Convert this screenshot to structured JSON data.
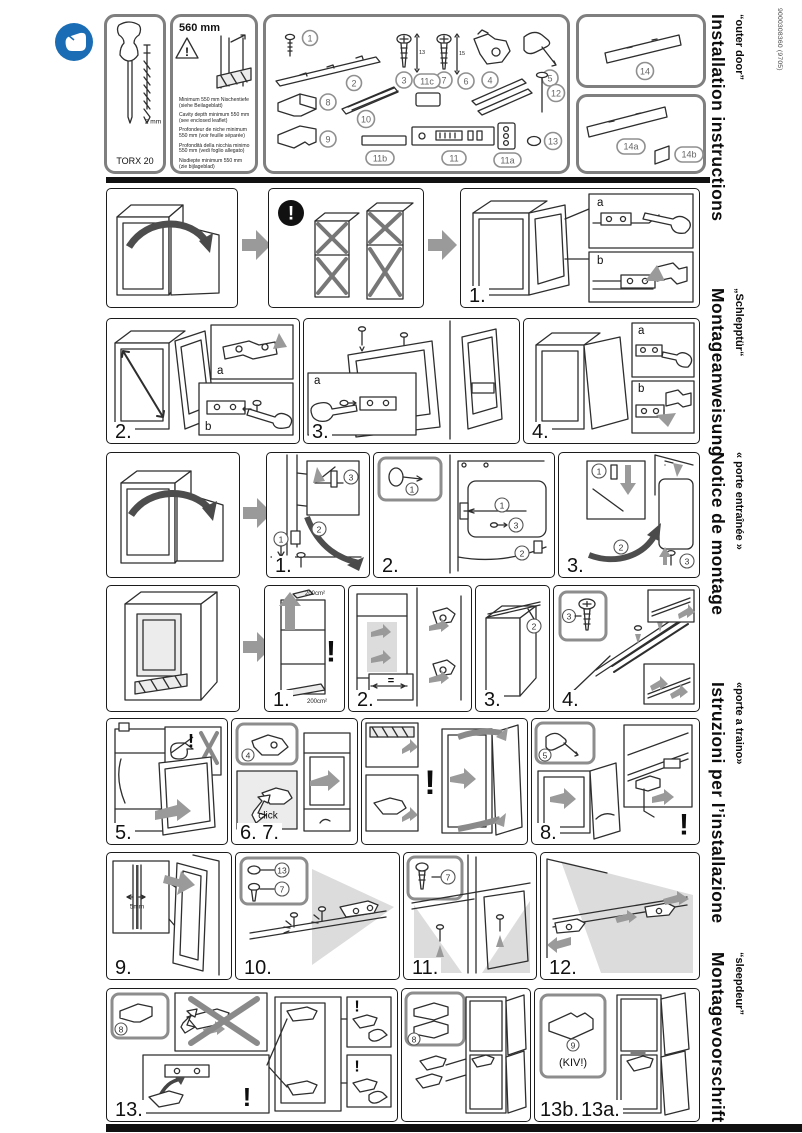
{
  "doc_code": "9000308360 (9705)",
  "sidebar": {
    "languages": [
      {
        "title": "Installation instructions",
        "subtitle": "“outer door”"
      },
      {
        "title": "Montageanweisung",
        "subtitle": "„Schlepptür“"
      },
      {
        "title": "Notice de montage",
        "subtitle": "« porte entraînée »"
      },
      {
        "title": "Istruzioni per l’installazione",
        "subtitle": "«porte a traino»"
      },
      {
        "title": "Montagevoorschrift",
        "subtitle": "“sleepdeur”"
      }
    ]
  },
  "tools": {
    "torx": "TORX 20",
    "bit_size": "2 mm"
  },
  "niche": {
    "depth": "560 mm",
    "warning_mark": "!",
    "notes": [
      "Minimum 550 mm Nischentiefe (siehe Beilageblatt)",
      "Cavity depth minimum 550 mm (see enclosed leaflet)",
      "Profondeur de niche minimum 550 mm (voir feuille séparée)",
      "Profondità della nicchia minimo 550 mm (vedi foglio allegato)",
      "Nisdiepte minimum 550 mm (zie bijlageblad)"
    ]
  },
  "parts": {
    "p1": "1",
    "p2": "2",
    "p3": "3",
    "p4": "4",
    "p5": "5",
    "p6": "6",
    "p7": "7",
    "p8": "8",
    "p9": "9",
    "p10": "10",
    "p11": "11",
    "p11a": "11a",
    "p11b": "11b",
    "p11c": "11c",
    "p12": "12",
    "p13": "13",
    "p14": "14",
    "p14a": "14a",
    "p14b": "14b",
    "dim3": "13",
    "dim7": "15"
  },
  "steps": {
    "s1": "1.",
    "s2": "2.",
    "s3": "3.",
    "s4": "4.",
    "s5": "5.",
    "s67": "6. 7.",
    "s8": "8.",
    "s9": "9.",
    "s10": "10.",
    "s11": "11.",
    "s12": "12.",
    "s13": "13.",
    "s13b": "13b.",
    "s13a": "13a."
  },
  "insets": {
    "a": "a",
    "b": "b"
  },
  "callouts": {
    "c1": "1",
    "c2": "2",
    "c3": "3",
    "c4": "4",
    "c5": "5",
    "c7": "7",
    "c8": "8",
    "c9": "9",
    "c12": "12",
    "c13": "13"
  },
  "annotations": {
    "exclamation": "!",
    "click": "click",
    "kiv": "(KIV!)",
    "gap": "5mm",
    "vent_top": "200cm²",
    "vent_bottom": "200cm²",
    "equal": "="
  }
}
